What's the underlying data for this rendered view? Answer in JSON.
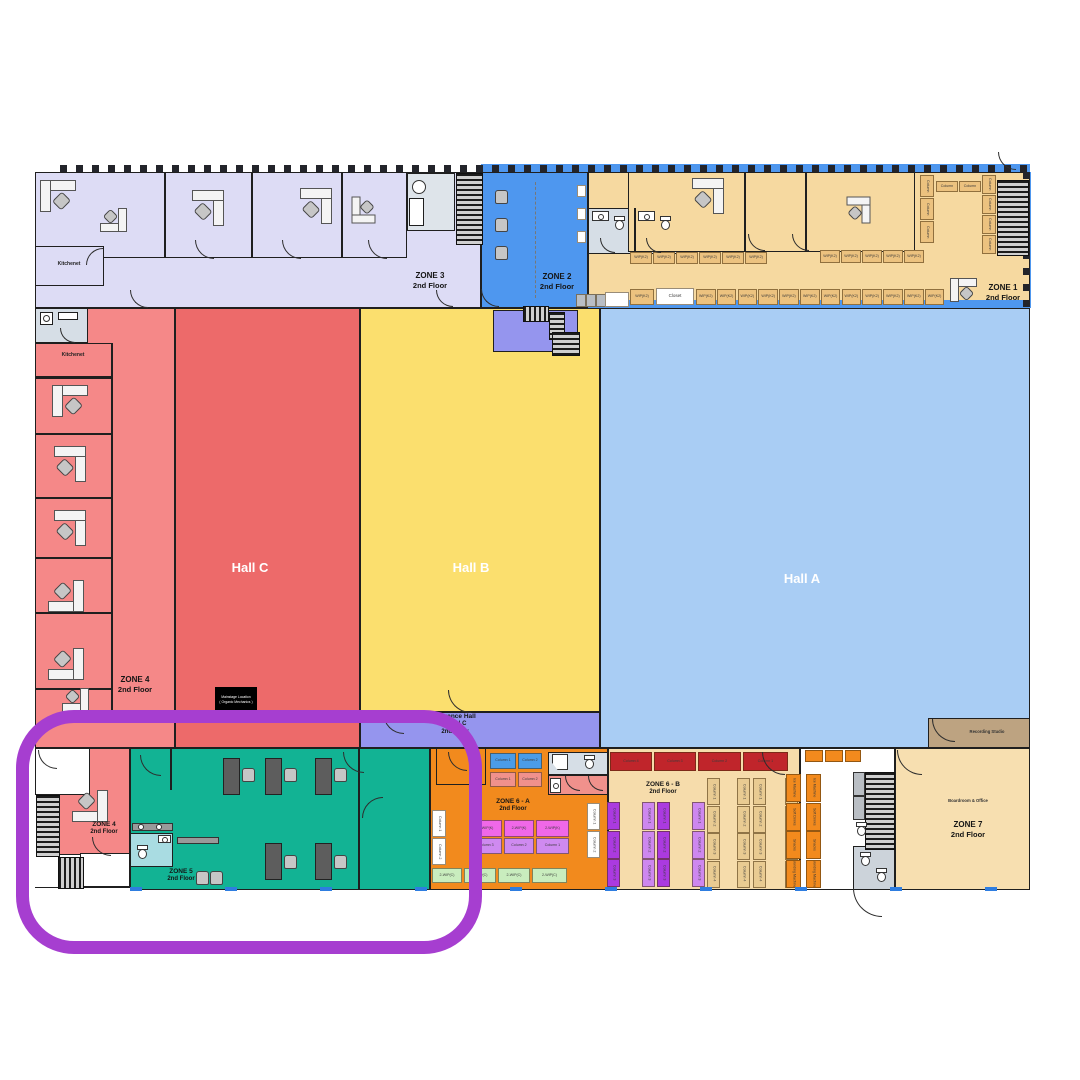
{
  "halls": {
    "hallA": {
      "name": "Hall A"
    },
    "hallB": {
      "name": "Hall B"
    },
    "hallC": {
      "name": "Hall C"
    }
  },
  "zones": {
    "zone1": {
      "name": "ZONE 1",
      "floor": "2nd Floor"
    },
    "zone2": {
      "name": "ZONE 2",
      "floor": "2nd Floor"
    },
    "zone3": {
      "name": "ZONE 3",
      "floor": "2nd Floor"
    },
    "zone4_mid": {
      "name": "ZONE 4",
      "floor": "2nd Floor"
    },
    "zone4_bottom": {
      "name": "ZONE 4",
      "floor": "2nd Floor"
    },
    "zone5": {
      "name": "ZONE 5",
      "floor": "2nd Floor"
    },
    "zone6a": {
      "name": "ZONE 6 - A",
      "floor": "2nd Floor"
    },
    "zone6b": {
      "name": "ZONE 6 - B",
      "floor": "2nd Floor"
    },
    "zone7": {
      "name": "ZONE 7",
      "floor": "2nd Floor"
    }
  },
  "rooms": {
    "kitchenet_top": "Kitchenet",
    "kitchenet_left": "Kitchenet",
    "closet": "Closet",
    "recording_studio": "Recording Studio",
    "boardroom": "Boardroom & Office",
    "entrance_hall": {
      "line1": "Entrance Hall",
      "line2": "A | B | C",
      "line3": "2nd Floor"
    },
    "stage_box": {
      "line1": "Mainstage Location",
      "line2": "( Organic Mechanics )"
    }
  },
  "cells": {
    "column": "Column",
    "column_labels": [
      "Column 1",
      "Column 2",
      "Column 3",
      "Column 4"
    ],
    "wip_k": "WIP(K2)",
    "wip_row": "2-WIP(K)",
    "wip_green": "2-WIP(C)",
    "vending": [
      "Ice Machine",
      "Soft Drinks",
      "Snacks",
      "Vending Machine"
    ]
  },
  "colors": {
    "highlight_ring": "#a63ed0",
    "hallA": "#a9cdf4",
    "hallB": "#fbdf6e",
    "hallC": "#ed6a6a",
    "zone1": "#f6d9a0",
    "zone2": "#4e97ef",
    "zone3": "#dddcf5",
    "zone4": "#f58888",
    "zone5": "#12b394",
    "zone6a": "#f28a1d",
    "zone6b": "#f6dcab",
    "zone7": "#f7dfb0",
    "entrance_strip": "#9595ee",
    "studio": "#bda381"
  }
}
